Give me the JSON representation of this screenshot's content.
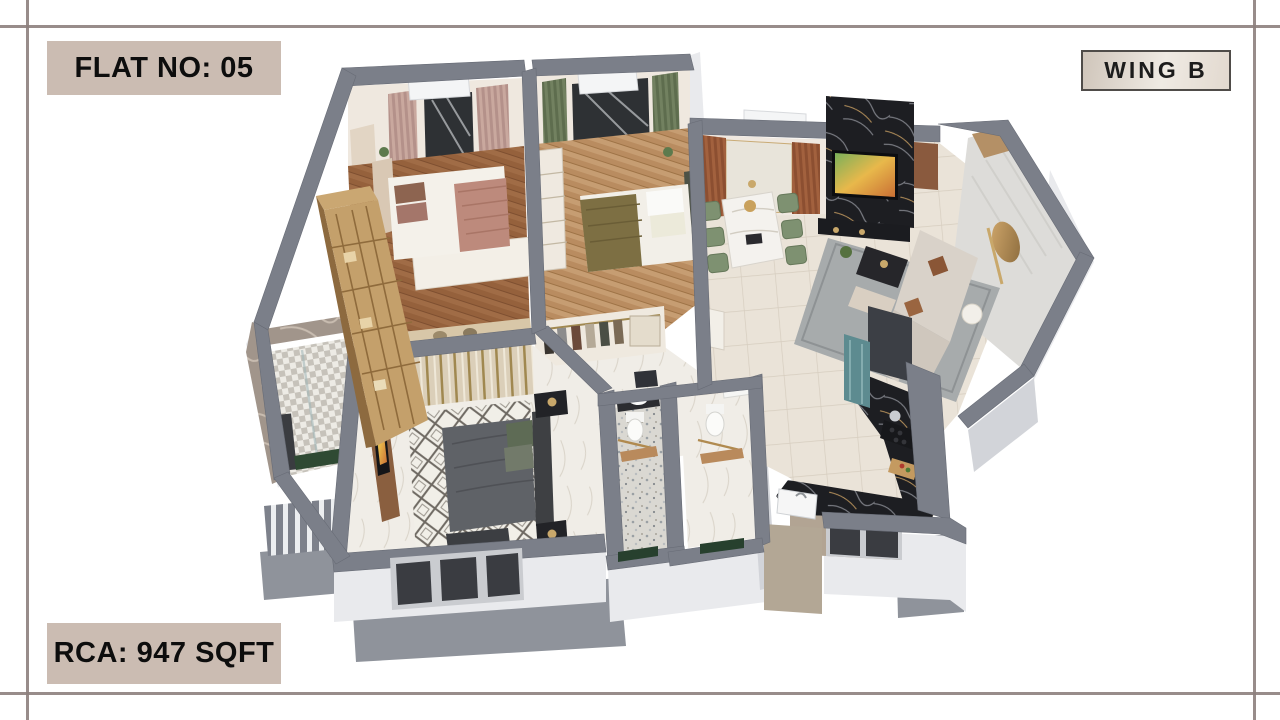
{
  "labels": {
    "flat_no": "FLAT NO: 05",
    "wing": "WING B",
    "rca": "RCA: 947 SQFT"
  },
  "theme": {
    "accent-beige": "#cbbcb2",
    "frame-line": "#8d807d",
    "wall-gray": "#7b7f89",
    "wall-face": "#e9eaed",
    "badge-text": "#0d0d0d"
  },
  "floor_plan": {
    "type": "isometric-3d-apartment-render",
    "rooms": [
      "bedroom-1",
      "bedroom-2",
      "dressing-area",
      "living-dining-room",
      "kitchen",
      "bathroom-1",
      "bathroom-2",
      "ensuite-bathroom",
      "master-bedroom",
      "balcony-left",
      "balcony-right"
    ],
    "key_colors": {
      "wood_floor_dark": "#a06c46",
      "wood_floor_light": "#c49a6e",
      "tile_floor": "#eae3d8",
      "marble_floor": "#f0ede7",
      "rug_gray": "#a7abac",
      "sofa_beige": "#d6cfc6",
      "dining_chair_green": "#7e9171",
      "counter_black_marble": "#1d1e22",
      "partition_glass_teal": "#5d8b90",
      "bed1_blanket_pink": "#bd8a7c",
      "bed2_blanket_olive": "#7d6f43",
      "master_bed_gray": "#5f6267",
      "gold_accent": "#c29962"
    }
  }
}
